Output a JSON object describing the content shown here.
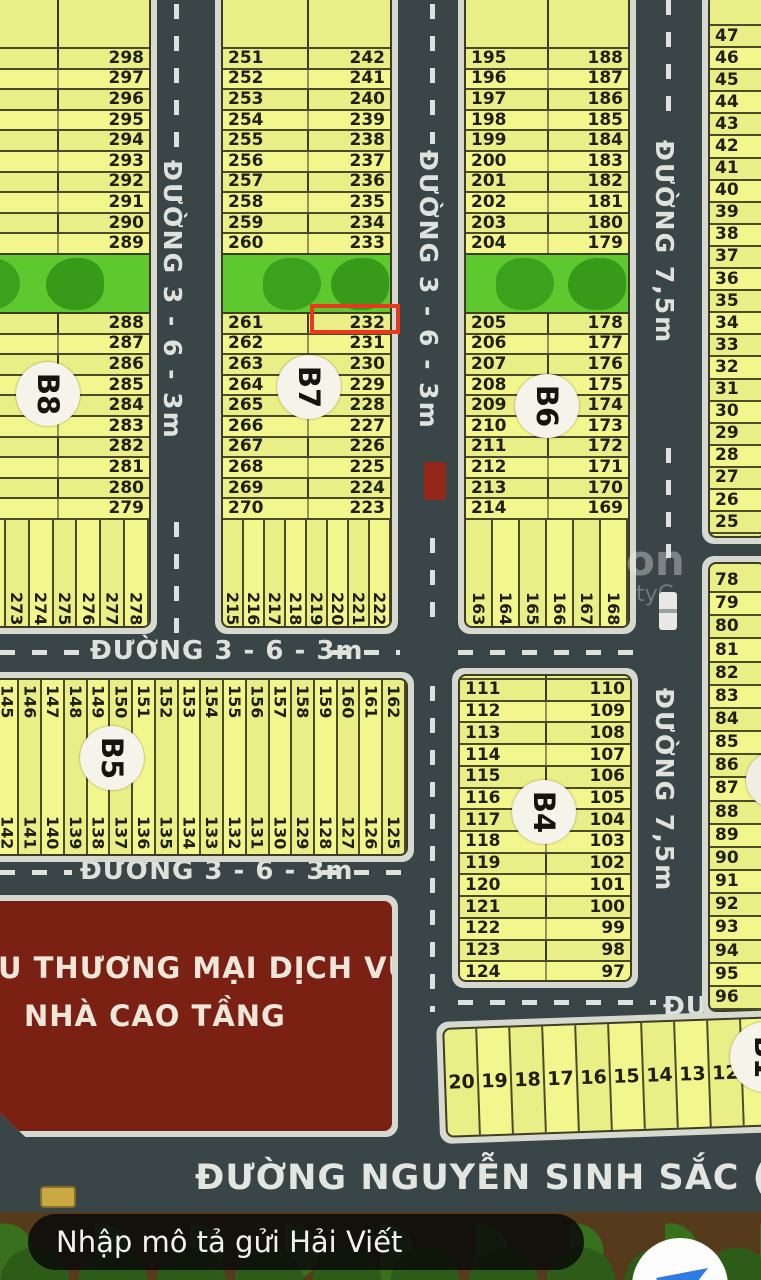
{
  "map": {
    "highlighted_plot": "232",
    "blocks": {
      "b8": {
        "label": "B8",
        "rows_top": [
          "298",
          "297",
          "296",
          "295",
          "294",
          "293",
          "292",
          "291",
          "290",
          "289"
        ],
        "rows_mid": [
          "288",
          "287",
          "286",
          "285",
          "284",
          "283",
          "282",
          "281",
          "280",
          "279"
        ],
        "strips_bottom": [
          "271",
          "272",
          "273",
          "274",
          "275",
          "276",
          "277",
          "278"
        ]
      },
      "b7": {
        "label": "B7",
        "top_left": [
          "251",
          "252",
          "253",
          "254",
          "255",
          "256",
          "257",
          "258",
          "259",
          "260"
        ],
        "top_right": [
          "242",
          "241",
          "240",
          "239",
          "238",
          "237",
          "236",
          "235",
          "234",
          "233"
        ],
        "mid_left": [
          "261",
          "262",
          "263",
          "264",
          "265",
          "266",
          "267",
          "268",
          "269",
          "270"
        ],
        "mid_right": [
          "232",
          "231",
          "230",
          "229",
          "228",
          "227",
          "226",
          "225",
          "224",
          "223"
        ],
        "strips_bottom": [
          "215",
          "216",
          "217",
          "218",
          "219",
          "220",
          "221",
          "222"
        ]
      },
      "b6": {
        "label": "B6",
        "top_left": [
          "195",
          "196",
          "197",
          "198",
          "199",
          "200",
          "201",
          "202",
          "203",
          "204"
        ],
        "top_right": [
          "188",
          "187",
          "186",
          "185",
          "184",
          "183",
          "182",
          "181",
          "180",
          "179"
        ],
        "mid_left": [
          "205",
          "206",
          "207",
          "208",
          "209",
          "210",
          "211",
          "212",
          "213",
          "214"
        ],
        "mid_right": [
          "178",
          "177",
          "176",
          "175",
          "174",
          "173",
          "172",
          "171",
          "170",
          "169"
        ],
        "strips_bottom": [
          "163",
          "164",
          "165",
          "166",
          "167",
          "168"
        ]
      },
      "east_top": {
        "rows": [
          "47",
          "46",
          "45",
          "44",
          "43",
          "42",
          "41",
          "40",
          "39",
          "38",
          "37",
          "36",
          "35",
          "34",
          "33",
          "32",
          "31",
          "30",
          "29",
          "28",
          "27",
          "26",
          "25"
        ]
      },
      "east_mid": {
        "rows": [
          "78",
          "79",
          "80",
          "81",
          "82",
          "83",
          "84",
          "85",
          "86",
          "87",
          "88",
          "89",
          "90",
          "91",
          "92",
          "93",
          "94",
          "95",
          "96"
        ]
      },
      "b5": {
        "label": "B5",
        "strips_top": [
          "144",
          "145",
          "146",
          "147",
          "148",
          "149",
          "150",
          "151",
          "152",
          "153",
          "154",
          "155",
          "156",
          "157",
          "158",
          "159",
          "160",
          "161",
          "162"
        ],
        "strips_bottom": [
          "143",
          "142",
          "141",
          "140",
          "139",
          "138",
          "137",
          "136",
          "135",
          "134",
          "133",
          "132",
          "131",
          "130",
          "129",
          "128",
          "127",
          "126",
          "125"
        ]
      },
      "b4": {
        "label": "B4",
        "rows_left": [
          "111",
          "112",
          "113",
          "114",
          "115",
          "116",
          "117",
          "118",
          "119",
          "120",
          "121",
          "122",
          "123",
          "124"
        ],
        "rows_right": [
          "110",
          "109",
          "108",
          "107",
          "106",
          "105",
          "104",
          "103",
          "102",
          "101",
          "100",
          "99",
          "98",
          "97"
        ]
      },
      "b1": {
        "label": "B1",
        "strips": [
          "20",
          "19",
          "18",
          "17",
          "16",
          "15",
          "14",
          "13",
          "12",
          "11"
        ]
      },
      "commercial": {
        "line1": "U THƯƠNG MẠI DỊCH VỤ",
        "line2": "NHÀ CAO TẦNG"
      }
    },
    "streets": {
      "left_vertical": "ĐƯỜNG 3 - 6 - 3m",
      "center_vertical": "ĐƯỜNG 3 - 6 - 3m",
      "right_vertical": "ĐƯỜNG 7,5m",
      "right_vertical_2": "ĐƯỜNG 7,5m",
      "horizontal_1": "ĐƯỜNG 3 - 6 - 3m",
      "horizontal_2": "ĐƯỜNG 3 - 6 - 3m",
      "east_horizontal": "ĐƯỜNG",
      "bottom": "ĐƯỜNG NGUYỄN SINH SẮC ( 9 - 15"
    },
    "watermark": {
      "frag1": "on",
      "frag2": "tyG"
    }
  },
  "chat": {
    "input_placeholder": "Nhập mô tả gửi Hải Viết"
  }
}
